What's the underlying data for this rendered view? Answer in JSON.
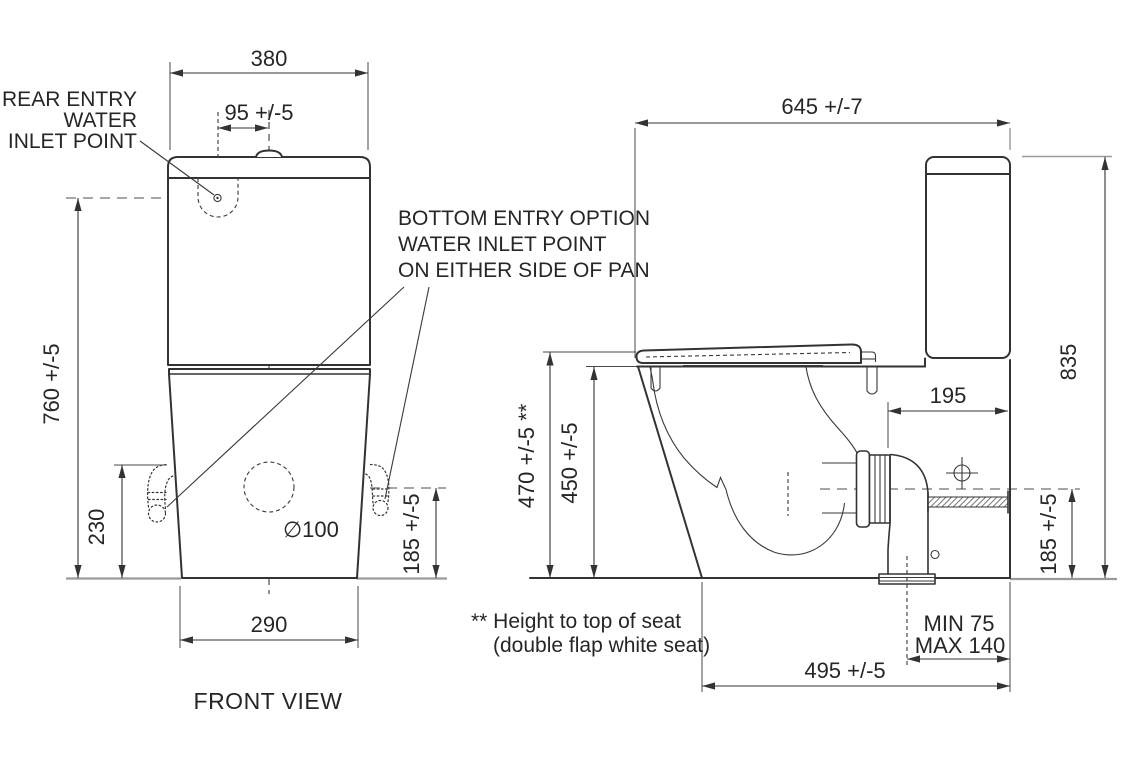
{
  "drawing": {
    "title": "Toilet suite dimension drawing",
    "colors": {
      "line": "#333333",
      "centerline_gray": "#9a9a9a",
      "text": "#262626",
      "background": "#ffffff"
    },
    "front": {
      "view_title": "FRONT VIEW",
      "labels": {
        "rear_entry": [
          "REAR ENTRY",
          "WATER",
          "INLET POINT"
        ],
        "bottom_entry": [
          "BOTTOM ENTRY OPTION",
          "WATER INLET POINT",
          "ON EITHER SIDE OF PAN"
        ],
        "outlet_diameter": "∅100"
      },
      "dims": {
        "tank_width": "380",
        "inlet_offset": "95 +/-5",
        "inlet_height": "760  +/-5",
        "bottom_entry_height": "230",
        "outlet_height": "185 +/-5",
        "base_width": "290"
      }
    },
    "side": {
      "dims": {
        "overall_depth": "645  +/-7",
        "overall_height": "835",
        "setout": "195",
        "seat_height": "470 +/-5 **",
        "pan_height": "450 +/-5",
        "outlet_height": "185 +/-5",
        "outlet_min": "MIN 75",
        "outlet_max": "MAX 140",
        "base_depth": "495 +/-5"
      },
      "footnote": [
        "** Height to top of seat",
        "(double flap white seat)"
      ]
    }
  }
}
